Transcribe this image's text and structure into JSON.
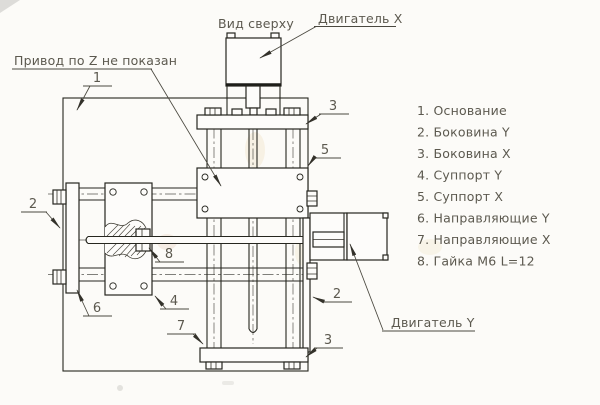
{
  "page": {
    "background": "#fcfbf8",
    "line_color": "#26261f",
    "text_color": "#5c594f"
  },
  "labels": {
    "view_top": "Вид сверху",
    "motor_x": "Двигатель X",
    "motor_y": "Двигатель Y",
    "z_note": "Привод по Z не показан"
  },
  "callouts": {
    "base": "1",
    "sidewall_y_left": "2",
    "sidewall_y_right": "2",
    "sidewall_x_top": "3",
    "sidewall_x_bottom": "3",
    "support_y": "4",
    "support_x": "5",
    "guides_y": "6",
    "guides_x": "7",
    "nut": "8"
  },
  "legend": {
    "items": [
      "1. Основание",
      "2. Боковина Y",
      "3. Боковина X",
      "4. Суппорт Y",
      "5. Суппорт X",
      "6. Направляющие Y",
      "7. Направляющие X",
      "8. Гайка М6 L=12"
    ]
  }
}
